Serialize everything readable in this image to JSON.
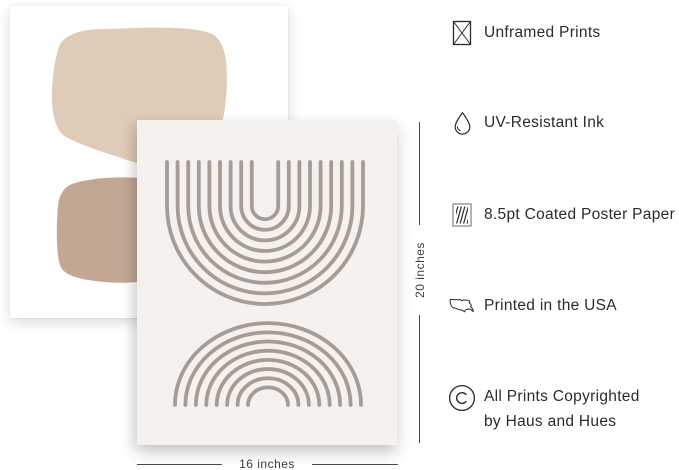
{
  "dimensions": {
    "width_label": "16 inches",
    "height_label": "20 inches"
  },
  "features": [
    {
      "icon": "no-frame-icon",
      "label": "Unframed Prints"
    },
    {
      "icon": "water-drop-icon",
      "label": "UV-Resistant Ink"
    },
    {
      "icon": "coated-paper-icon",
      "label": "8.5pt Coated Poster Paper"
    },
    {
      "icon": "usa-map-icon",
      "label": "Printed in the USA"
    },
    {
      "icon": "copyright-icon",
      "label": "All Prints Copyrighted",
      "label2": "by Haus and Hues"
    }
  ],
  "colors": {
    "blob_beige": "#dfccb8",
    "blob_tan": "#c2a795",
    "poster_bg": "#f4f1ee",
    "arc_line": "#a79c93",
    "text": "#2b2b2b",
    "icon_stroke": "#2a2a2a",
    "dim_line": "#4a4a4a"
  }
}
